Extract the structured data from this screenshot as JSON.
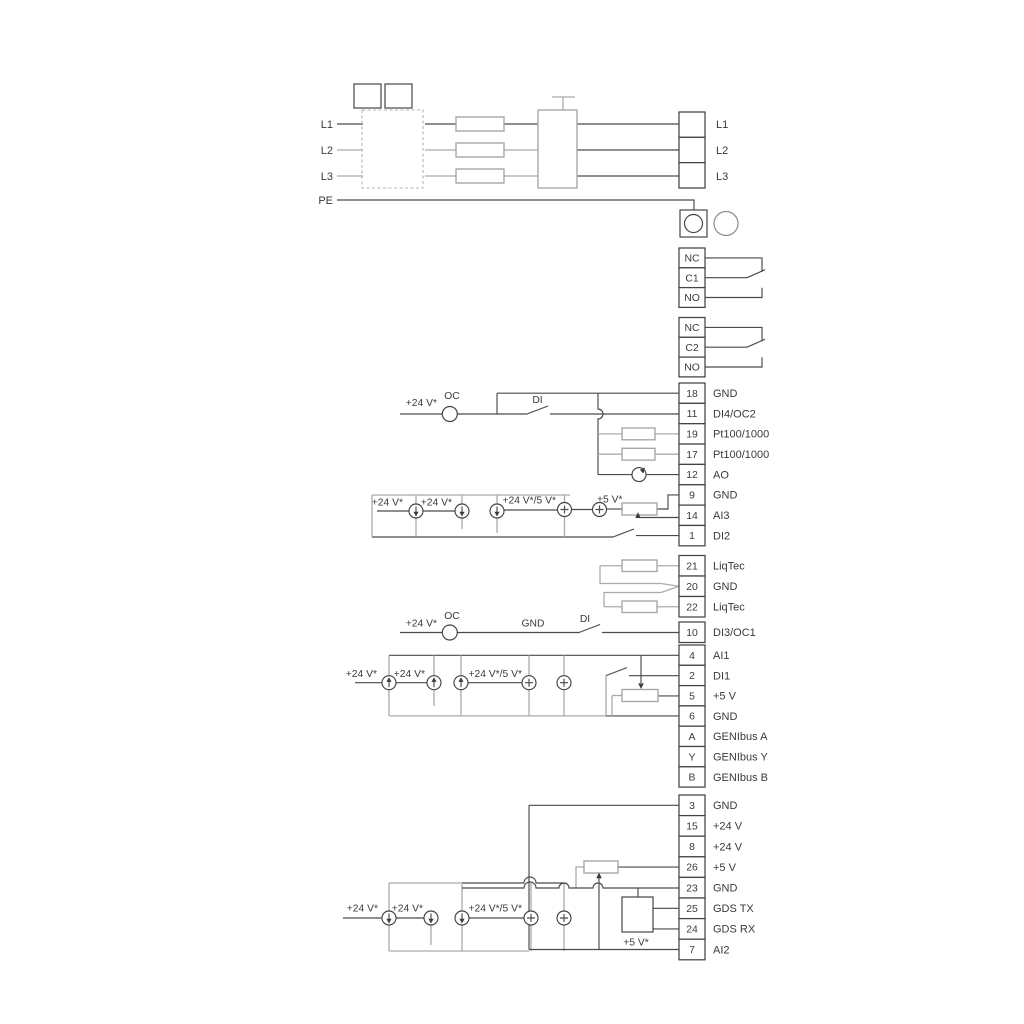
{
  "diagram_type": "pump-drive-wiring-diagram",
  "mains": {
    "left_labels": [
      "L1",
      "L2",
      "L3",
      "PE"
    ],
    "output_labels": [
      "L1",
      "L2",
      "L3"
    ]
  },
  "relays": [
    {
      "cells": [
        "NC",
        "C1",
        "NO"
      ]
    },
    {
      "cells": [
        "NC",
        "C2",
        "NO"
      ]
    }
  ],
  "terminal_groups": {
    "io1": [
      {
        "num": "18",
        "label": "GND"
      },
      {
        "num": "11",
        "label": "DI4/OC2"
      },
      {
        "num": "19",
        "label": "Pt100/1000"
      },
      {
        "num": "17",
        "label": "Pt100/1000"
      },
      {
        "num": "12",
        "label": "AO"
      },
      {
        "num": "9",
        "label": "GND"
      },
      {
        "num": "14",
        "label": "AI3"
      },
      {
        "num": "1",
        "label": "DI2"
      }
    ],
    "liqtec": [
      {
        "num": "21",
        "label": "LiqTec"
      },
      {
        "num": "20",
        "label": "GND"
      },
      {
        "num": "22",
        "label": "LiqTec"
      }
    ],
    "di3": [
      {
        "num": "10",
        "label": "DI3/OC1"
      }
    ],
    "io2": [
      {
        "num": "4",
        "label": "AI1"
      },
      {
        "num": "2",
        "label": "DI1"
      },
      {
        "num": "5",
        "label": "+5 V"
      },
      {
        "num": "6",
        "label": "GND"
      },
      {
        "num": "A",
        "label": "GENIbus A"
      },
      {
        "num": "Y",
        "label": "GENIbus Y"
      },
      {
        "num": "B",
        "label": "GENIbus B"
      }
    ],
    "io3": [
      {
        "num": "3",
        "label": "GND"
      },
      {
        "num": "15",
        "label": "+24 V"
      },
      {
        "num": "8",
        "label": "+24 V"
      },
      {
        "num": "26",
        "label": "+5 V"
      },
      {
        "num": "23",
        "label": "GND"
      },
      {
        "num": "25",
        "label": "GDS TX"
      },
      {
        "num": "24",
        "label": "GDS RX"
      },
      {
        "num": "7",
        "label": "AI2"
      }
    ]
  },
  "annotations": {
    "v24": "+24 V*",
    "v24_5": "+24 V*/5 V*",
    "v5": "+5 V*",
    "oc": "OC",
    "di": "DI",
    "gnd": "GND"
  },
  "colors": {
    "wire_dark": "#4a4a4a",
    "wire_gray": "#ababab",
    "text": "#3a3a3a",
    "background": "#ffffff"
  }
}
